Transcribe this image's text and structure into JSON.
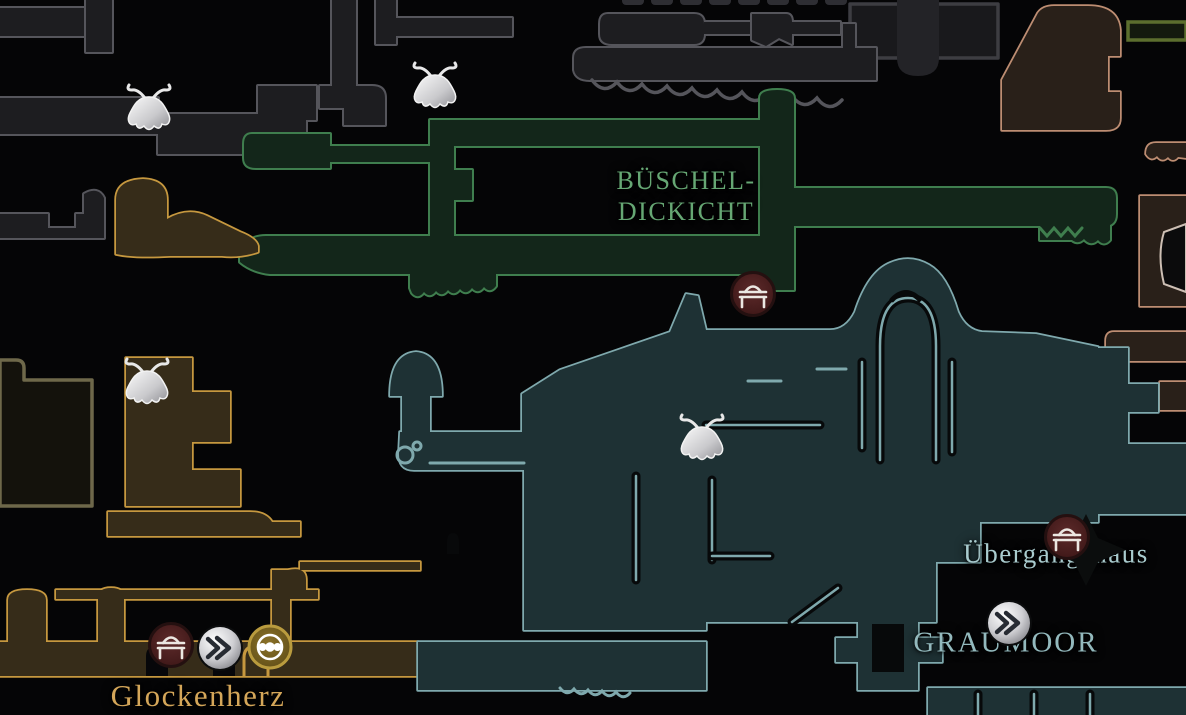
{
  "map": {
    "background_color": "#050506",
    "regions": {
      "thicket": {
        "label_line1": "BÜSCHEL-",
        "label_line2": "DICKICHT",
        "outline_color": "#3f7e4e",
        "label_color": "#66a774"
      },
      "greymoor": {
        "label": "GRAUMOOR",
        "outline_color": "#7fa9ad",
        "label_color": "#93b9bd"
      },
      "bellheart": {
        "label": "Glockenherz",
        "outline_color": "#c6983f",
        "label_color": "#d4a659"
      },
      "unexplored_top": {
        "outline_color": "#55555b"
      },
      "cliffs_right": {
        "outline_color": "#bd8d72"
      }
    },
    "locations": {
      "halfway_house": {
        "label": "Übergangshaus",
        "label_color": "#a9cbce"
      }
    },
    "markers": {
      "bench": {
        "icon": "bench-icon",
        "fill": "#4e2222",
        "glyph_color": "#ece7e2"
      },
      "bellway": {
        "icon": "bellway-chevron-icon",
        "fill": "#c9c9cc",
        "glyph_color": "#272b33"
      },
      "station": {
        "icon": "bead-station-icon",
        "fill": "#6f5a1d",
        "glyph_color": "#ffffff"
      },
      "flower": {
        "icon": "bell-flower-marker",
        "fill": "#e8e8e8"
      }
    }
  }
}
